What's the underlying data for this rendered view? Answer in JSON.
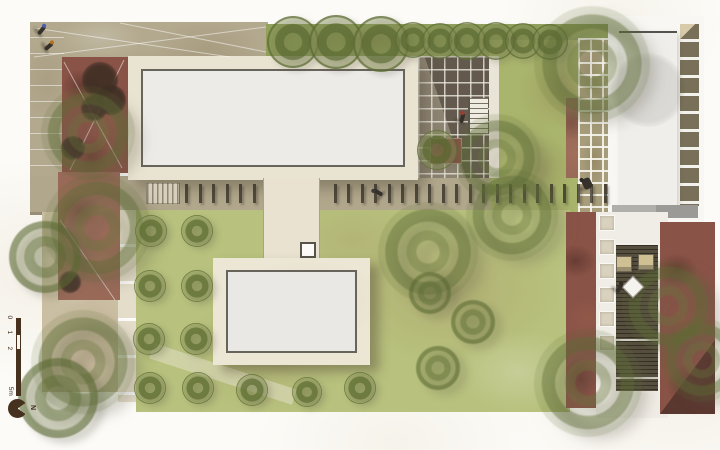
{
  "annotation": {
    "scale_bar": {
      "label_0": "0",
      "label_1": "1",
      "label_2": "2",
      "label_end": "5m"
    },
    "north_label": "N"
  },
  "palette": {
    "paper": "#fbfaf6",
    "tan_paving": "#b3a98e",
    "beige_paving": "#cbbfa3",
    "cream_building": "#e9e3d2",
    "roof": "#ecebe7",
    "lawn": "#b8c17d",
    "hedge": "#92a25d",
    "red_paving": "#8a5347",
    "courtyard": "#8d8372",
    "deck_wood": "#574f3e",
    "tree_olive": "#68763c",
    "annotation_brown": "#46301e"
  },
  "plan": {
    "trees": [
      {
        "k": "T",
        "x": 293,
        "y": 42,
        "r": 26
      },
      {
        "k": "T",
        "x": 336,
        "y": 42,
        "r": 27
      },
      {
        "k": "T",
        "x": 381,
        "y": 44,
        "r": 28
      },
      {
        "k": "T",
        "x": 413,
        "y": 40,
        "r": 18
      },
      {
        "k": "T",
        "x": 440,
        "y": 41,
        "r": 18
      },
      {
        "k": "T",
        "x": 467,
        "y": 41,
        "r": 19
      },
      {
        "k": "T",
        "x": 496,
        "y": 41,
        "r": 19
      },
      {
        "k": "T",
        "x": 523,
        "y": 41,
        "r": 18
      },
      {
        "k": "T",
        "x": 550,
        "y": 42,
        "r": 18
      },
      {
        "k": "L",
        "x": 592,
        "y": 64,
        "r": 58
      },
      {
        "k": "L",
        "x": 497,
        "y": 158,
        "r": 44
      },
      {
        "k": "L",
        "x": 512,
        "y": 215,
        "r": 46
      },
      {
        "k": "L",
        "x": 428,
        "y": 252,
        "r": 50
      },
      {
        "k": "L",
        "x": 88,
        "y": 133,
        "r": 47
      },
      {
        "k": "L",
        "x": 97,
        "y": 228,
        "r": 54
      },
      {
        "k": "M",
        "x": 45,
        "y": 257,
        "r": 36
      },
      {
        "k": "L",
        "x": 83,
        "y": 362,
        "r": 52
      },
      {
        "k": "M",
        "x": 58,
        "y": 398,
        "r": 40
      },
      {
        "k": "L",
        "x": 668,
        "y": 306,
        "r": 46
      },
      {
        "k": "L",
        "x": 702,
        "y": 360,
        "r": 42
      },
      {
        "k": "L",
        "x": 588,
        "y": 383,
        "r": 54
      },
      {
        "k": "S",
        "x": 437,
        "y": 150,
        "r": 20
      },
      {
        "k": "M",
        "x": 430,
        "y": 293,
        "r": 21
      },
      {
        "k": "M",
        "x": 473,
        "y": 322,
        "r": 22
      },
      {
        "k": "M",
        "x": 438,
        "y": 368,
        "r": 22
      },
      {
        "k": "S",
        "x": 151,
        "y": 231,
        "r": 16
      },
      {
        "k": "S",
        "x": 150,
        "y": 286,
        "r": 16
      },
      {
        "k": "S",
        "x": 149,
        "y": 339,
        "r": 16
      },
      {
        "k": "S",
        "x": 150,
        "y": 388,
        "r": 16
      },
      {
        "k": "S",
        "x": 197,
        "y": 231,
        "r": 16
      },
      {
        "k": "S",
        "x": 197,
        "y": 286,
        "r": 16
      },
      {
        "k": "S",
        "x": 196,
        "y": 339,
        "r": 16
      },
      {
        "k": "S",
        "x": 198,
        "y": 388,
        "r": 16
      },
      {
        "k": "S",
        "x": 252,
        "y": 390,
        "r": 16
      },
      {
        "k": "S",
        "x": 307,
        "y": 392,
        "r": 15
      },
      {
        "k": "S",
        "x": 360,
        "y": 388,
        "r": 16
      }
    ],
    "shrubs": [
      [
        100,
        80,
        18
      ],
      [
        111,
        100,
        15
      ],
      [
        94,
        108,
        13
      ],
      [
        73,
        148,
        12
      ],
      [
        70,
        282,
        11
      ]
    ],
    "walkway_ticks": {
      "x_start": 185,
      "x_end": 606,
      "y": 184,
      "step": 13.5,
      "skip": [
        258,
        322
      ]
    },
    "stepping_stones": {
      "x": 599,
      "y_start": 215,
      "count": 6,
      "gap": 24,
      "size": 16
    },
    "people": [
      {
        "k": "p",
        "x": 34,
        "y": 24,
        "rot": 40,
        "accent": "#4a5cb5"
      },
      {
        "k": "p",
        "x": 41,
        "y": 40,
        "rot": 50,
        "accent": "#b5701e"
      },
      {
        "k": "p",
        "x": 372,
        "y": 186,
        "rot": -60,
        "accent": "#3a3a3a"
      },
      {
        "k": "p",
        "x": 455,
        "y": 112,
        "rot": 15,
        "accent": "#a23b2e"
      },
      {
        "k": "p",
        "x": 612,
        "y": 282,
        "rot": 30,
        "accent": "#2f2b24"
      },
      {
        "k": "cart",
        "x": 578,
        "y": 178,
        "rot": -25,
        "accent": "#2f2b24"
      }
    ],
    "furniture": [
      {
        "k": "chair",
        "x": 616,
        "y": 256
      },
      {
        "k": "chair",
        "x": 638,
        "y": 254
      },
      {
        "k": "diamond",
        "x": 625,
        "y": 279
      }
    ]
  }
}
